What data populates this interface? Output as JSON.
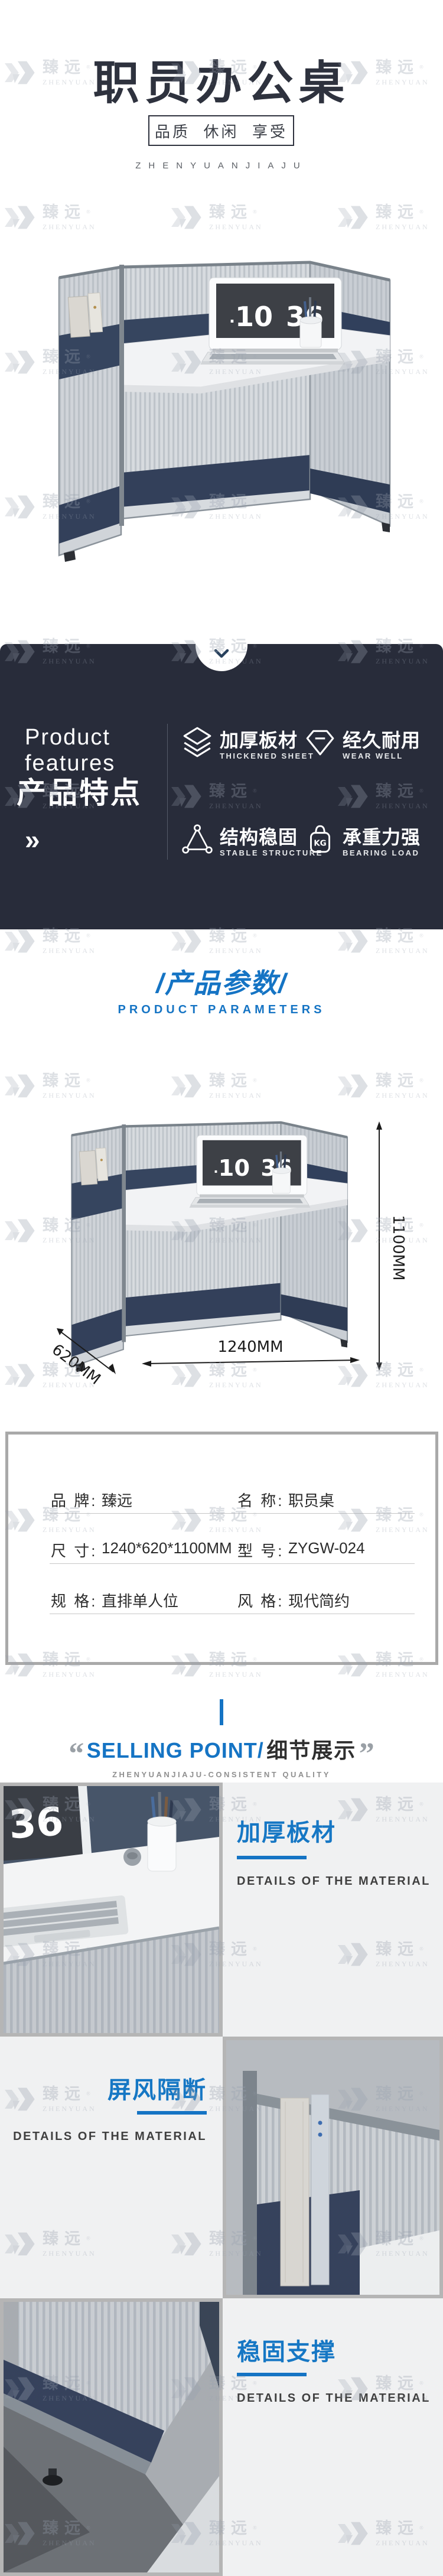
{
  "brand": {
    "cn": "臻远",
    "en": "ZHENYUAN",
    "reg": "®",
    "latin_full": "ZHENYUANJIAJU"
  },
  "header": {
    "title": "职员办公桌",
    "subtitle": "品质  休闲  享受"
  },
  "hero": {
    "clock_dot": ".",
    "clock_hour": "10",
    "clock_min": "36"
  },
  "features": {
    "en_title": "Product features",
    "cn_title": "产品特点",
    "more_symbol": "»",
    "kg_label": "KG",
    "items": [
      {
        "cn": "加厚板材",
        "en": "THICKENED SHEET"
      },
      {
        "cn": "经久耐用",
        "en": "WEAR WELL"
      },
      {
        "cn": "结构稳固",
        "en": "STABLE STRUCTURE"
      },
      {
        "cn": "承重力强",
        "en": "BEARING LOAD"
      }
    ]
  },
  "params_header": {
    "cn": "/产品参数/",
    "en": "PRODUCT PARAMETERS"
  },
  "dimensions": {
    "height": "1100MM",
    "depth": "620MM",
    "width": "1240MM"
  },
  "spec_table": {
    "rows": [
      {
        "l1": "品 牌:",
        "v1": "臻远",
        "l2": "名 称:",
        "v2": "职员桌"
      },
      {
        "l1": "尺 寸:",
        "v1": "1240*620*1100MM",
        "l2": "型 号:",
        "v2": "ZYGW-024"
      },
      {
        "l1": "规 格:",
        "v1": "直排单人位",
        "l2": "风 格:",
        "v2": "现代简约"
      }
    ]
  },
  "selling": {
    "quote_open": "“",
    "quote_close": "”",
    "en": "SELLING POINT/",
    "cn": "细节展示",
    "caption": "ZHENYUANJIAJU-CONSISTENT QUALITY"
  },
  "detail_blocks": [
    {
      "title": "加厚板材",
      "subtitle": "DETAILS OF THE MATERIAL"
    },
    {
      "title": "屏风隔断",
      "subtitle": "DETAILS OF THE MATERIAL"
    },
    {
      "title": "稳固支撑",
      "subtitle": "DETAILS OF THE MATERIAL"
    }
  ],
  "colors": {
    "accent": "#1574c4",
    "dark_bg": "#282c3a",
    "navy_panel": "#36455f",
    "panel_gray": "#f0f1f2"
  }
}
